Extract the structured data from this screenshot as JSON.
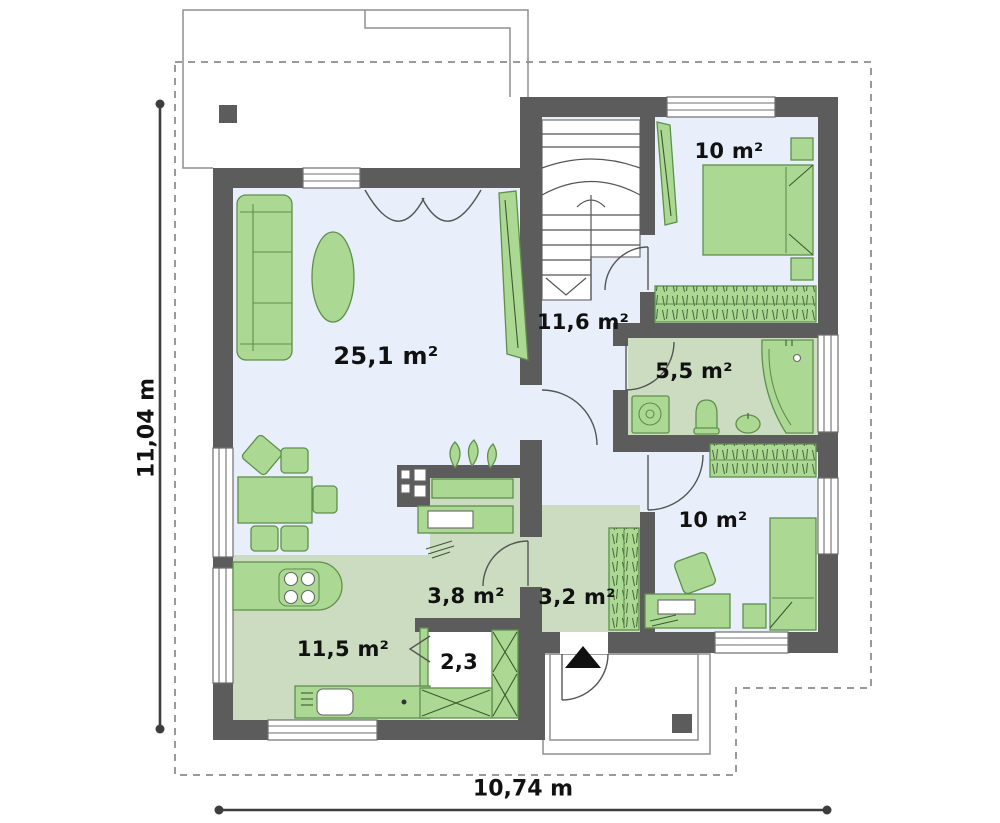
{
  "plan": {
    "dimensions": {
      "width_label": "10,74 m",
      "height_label": "11,04 m"
    },
    "rooms": {
      "living": {
        "name": "living-room",
        "area": "25,1 m²"
      },
      "hall_upper": {
        "name": "stair-hall",
        "area": "11,6 m²"
      },
      "bedroom_top": {
        "name": "bedroom-top",
        "area": "10 m²"
      },
      "bathroom": {
        "name": "bathroom",
        "area": "5,5 m²"
      },
      "bedroom_bottom": {
        "name": "bedroom-bottom",
        "area": "10 m²"
      },
      "office": {
        "name": "office",
        "area": "3,8 m²"
      },
      "hall_entry": {
        "name": "entry-hall",
        "area": "3,2 m²"
      },
      "pantry": {
        "name": "pantry",
        "area": "2,3"
      },
      "kitchen": {
        "name": "kitchen",
        "area": "11,5 m²"
      }
    },
    "icons": {
      "entrance_arrow": "triangle-up"
    },
    "colors": {
      "wall": "#5c5c5c",
      "floor_light": "#e9effa",
      "floor_green": "#cbdcc1",
      "furniture": "#abd994",
      "furniture_stroke": "#5f8f4c",
      "outline": "#8f8f8f",
      "dash": "#9a9a9a",
      "dimension": "#3d3d3d",
      "label": "#111111"
    }
  }
}
